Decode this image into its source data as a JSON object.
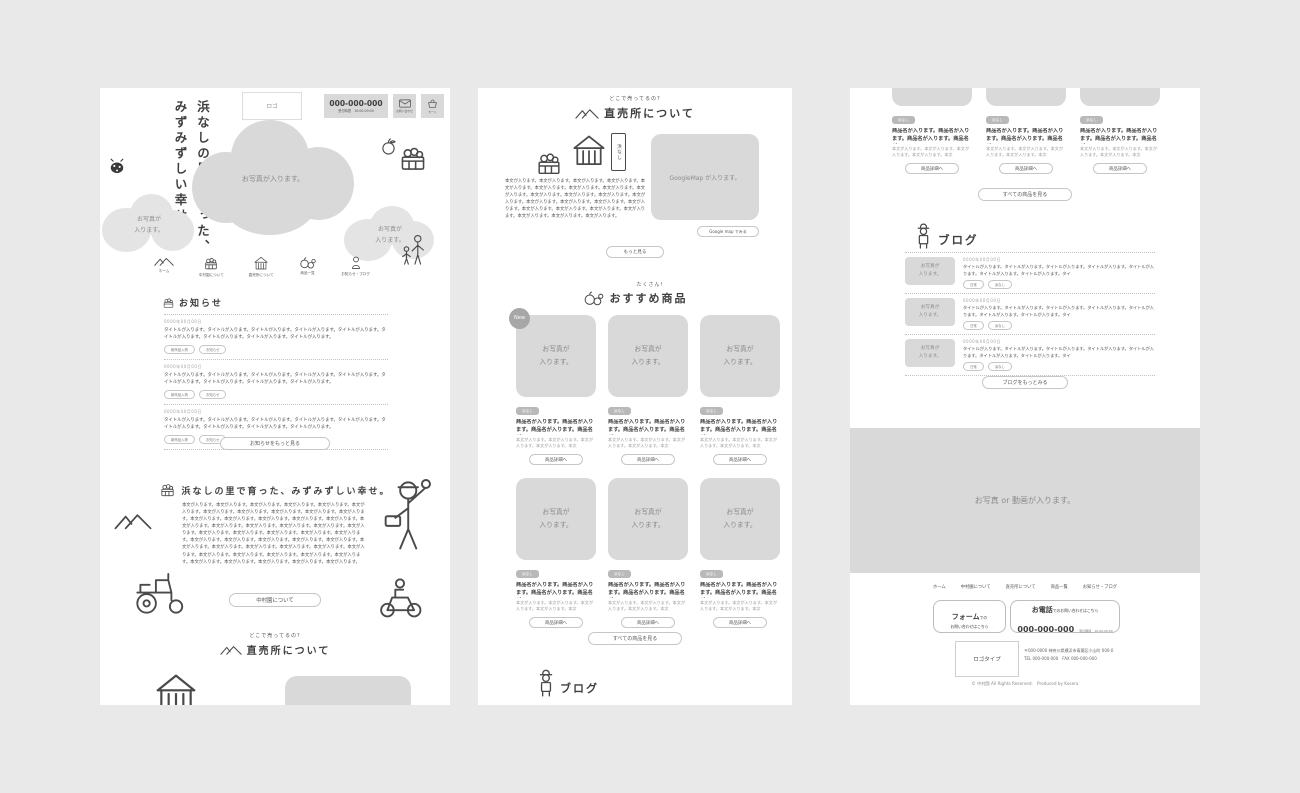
{
  "header": {
    "logo": "ロゴ",
    "phone": "000-000-000",
    "hours": "受付時間　10:00-00:00",
    "contact_label": "お問い合わせ",
    "cart_label": "カート"
  },
  "hero": {
    "catch_line1": "浜なしの里で育った、",
    "catch_line2": "みずみずしい幸せ。",
    "photo_main": "お写真が入ります。",
    "photo_left": "お写真が\n入ります。",
    "photo_right": "お写真が\n入ります。"
  },
  "nav": {
    "items": [
      {
        "label": "ホーム",
        "icon": "mountains-icon"
      },
      {
        "label": "中村園について",
        "icon": "fruit-box-icon"
      },
      {
        "label": "直売所について",
        "icon": "hut-icon"
      },
      {
        "label": "商品一覧",
        "icon": "fruits-icon"
      },
      {
        "label": "お知らせ・ブログ",
        "icon": "person-icon"
      }
    ]
  },
  "news": {
    "title": "お知らせ",
    "items": [
      {
        "date": "0000年00月00日",
        "text": "タイトルが入ります。タイトルが入ります。タイトルが入ります。タイトルが入ります。タイトルが入ります。タイトルが入ります。タイトルが入ります。タイトルが入ります。タイトルが入ります。",
        "tags": [
          "新商品入荷",
          "お知らせ"
        ]
      },
      {
        "date": "0000年00月00日",
        "text": "タイトルが入ります。タイトルが入ります。タイトルが入ります。タイトルが入ります。タイトルが入ります。タイトルが入ります。タイトルが入ります。タイトルが入ります。タイトルが入ります。",
        "tags": [
          "新商品入荷",
          "お知らせ"
        ]
      },
      {
        "date": "0000年00月00日",
        "text": "タイトルが入ります。タイトルが入ります。タイトルが入ります。タイトルが入ります。タイトルが入ります。タイトルが入ります。タイトルが入ります。タイトルが入ります。タイトルが入ります。",
        "tags": [
          "新商品入荷",
          "お知らせ"
        ]
      }
    ],
    "more_button": "お知らせをもっと見る"
  },
  "about": {
    "title": "浜なしの里で育った、みずみずしい幸せ。",
    "body": "本文が入ります。本文が入ります。本文が入ります。本文が入ります。本文が入ります。本文が入ります。本文が入ります。本文が入ります。本文が入ります。本文が入ります。本文が入ります。本文が入ります。本文が入ります。本文が入ります。本文が入ります。本文が入ります。本文が入ります。本文が入ります。本文が入ります。本文が入ります。本文が入ります。本文が入ります。本文が入ります。本文が入ります。本文が入ります。本文が入ります。本文が入ります。本文が入ります。本文が入ります。本文が入ります。本文が入ります。本文が入ります。本文が入ります。本文が入ります。本文が入ります。本文が入ります。本文が入ります。本文が入ります。本文が入ります。本文が入ります。本文が入ります。本文が入ります。本文が入ります。本文が入ります。本文が入ります。本文が入ります。本文が入ります。本文が入ります。",
    "button": "中村園について"
  },
  "shop": {
    "subtitle": "どこで売ってるの?",
    "title": "直売所について",
    "banner": "浜なし",
    "body": "本文が入ります。本文が入ります。本文が入ります。本文が入ります。本文が入ります。本文が入ります。本文が入ります。本文が入ります。本文が入ります。本文が入ります。本文が入ります。本文が入ります。本文が入ります。本文が入ります。本文が入ります。本文が入ります。本文が入ります。本文が入ります。本文が入ります。本文が入ります。本文が入ります。本文が入ります。本文が入ります。本文が入ります。",
    "map_placeholder": "GoogleMap が入ります。",
    "map_button": "Google map でみる",
    "more_button": "もっと見る"
  },
  "products": {
    "subtitle": "たくさん!",
    "title": "おすすめ商品",
    "new_badge": "New",
    "photo": "お写真が\n入ります。",
    "tag": "浜なし",
    "name": "商品名が入ります。商品名が入ります。商品名が入ります。商品名が入",
    "desc": "本文が入ります。本文が入ります。本文が入ります。本文が入ります。本文",
    "detail_button": "商品詳細へ",
    "all_button": "すべての商品を見る"
  },
  "blog": {
    "title": "ブログ",
    "thumb": "お写真が\n入ります。",
    "items": [
      {
        "date": "0000年00月00日",
        "text": "タイトルが入ります。タイトルが入ります。タイトルが入ります。タイトルが入ります。タイトルが入ります。タイトルが入ります。タイトルが入ります。タイ",
        "tags": [
          "日常",
          "浜なし"
        ]
      },
      {
        "date": "0000年00月00日",
        "text": "タイトルが入ります。タイトルが入ります。タイトルが入ります。タイトルが入ります。タイトルが入ります。タイトルが入ります。タイトルが入ります。タイ",
        "tags": [
          "日常",
          "浜なし"
        ]
      },
      {
        "date": "0000年00月00日",
        "text": "タイトルが入ります。タイトルが入ります。タイトルが入ります。タイトルが入ります。タイトルが入ります。タイトルが入ります。タイトルが入ります。タイ",
        "tags": [
          "日常",
          "浜なし"
        ]
      }
    ],
    "more_button": "ブログをもっとみる"
  },
  "media": {
    "placeholder": "お写真 or 動画が入ります。"
  },
  "footer": {
    "nav": [
      "ホーム",
      "中村園について",
      "直売所について",
      "商品一覧",
      "お知らせ・ブログ"
    ],
    "form_line1_big": "フォーム",
    "form_line1_small": "での",
    "form_line2": "お問い合わせはこちら",
    "tel_line1_big": "お電話",
    "tel_line1_small": "でのお問い合わせはこちら",
    "tel_number": "000-000-000",
    "tel_hours": "受付時間　10:00-00:00",
    "logo": "ロゴタイプ",
    "address": "〒000-0000 神奈川県横浜市青葉区小山町 000-0",
    "telfax": "TEL 000-000-000　FAX 000-000-000",
    "copyright": "© 中村園 All Rights Reserved.　Produced by Kosera"
  }
}
